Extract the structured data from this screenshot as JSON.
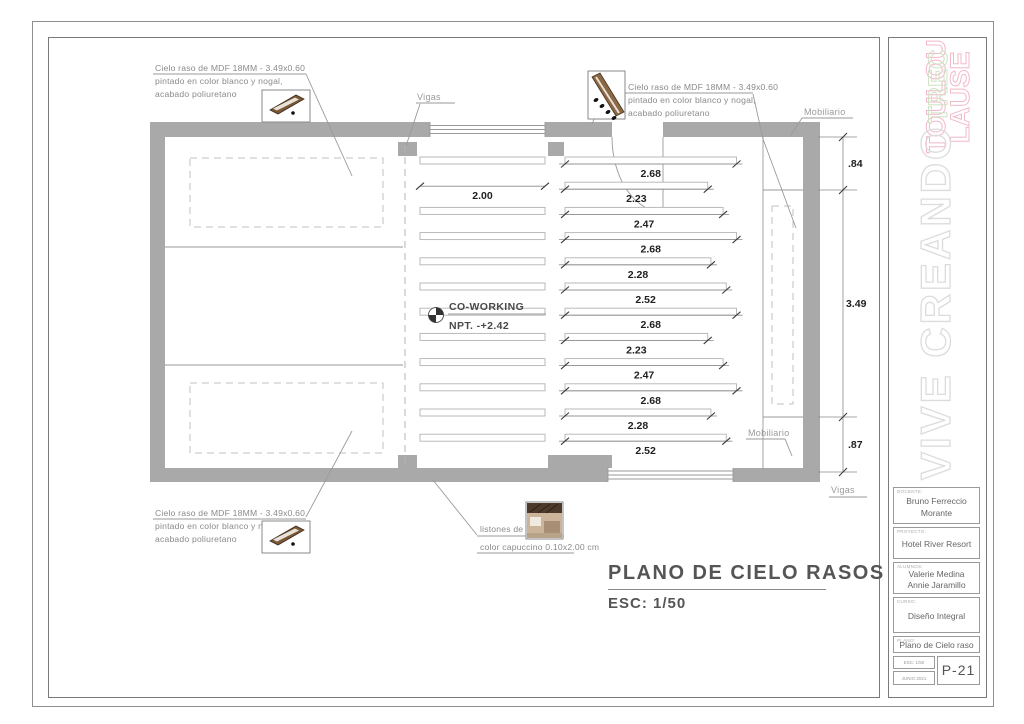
{
  "colors": {
    "wall": "#a9a9a9",
    "line": "#9a9a9a",
    "dim_text": "#1f1f1f",
    "note_text": "#8a8a8a",
    "accent_pink": "#f2b9c9",
    "accent_green": "#cfe3c5",
    "watermark": "#dcdcdc",
    "title_text": "#555555"
  },
  "drawing": {
    "title": "PLANO DE CIELO RASOS",
    "scale": "ESC: 1/50",
    "room": {
      "name": "CO-WORKING",
      "level": "NPT. -+2.42"
    },
    "notes": {
      "mdf_top_left": [
        "Cielo raso de MDF 18MM - 3.49x0.60",
        "pintado en color blanco y nogal,",
        "acabado poliuretano"
      ],
      "mdf_top_right": [
        "Cielo raso de MDF 18MM - 3.49x0.60",
        "pintado en color blanco y nogal,",
        "acabado poliuretano"
      ],
      "mdf_bottom_left": [
        "Cielo raso de MDF 18MM - 3.49x0.60",
        "pintado en color blanco y nogal,",
        "acabado poliuretano"
      ],
      "listones": [
        "listones de madera,",
        "color capuccino 0.10x2.00 cm"
      ]
    },
    "labels": {
      "vigas_top": "Vigas",
      "vigas_bottom": "Vigas",
      "mobiliario_top": "Mobiliario",
      "mobiliario_bottom": "Mobiliario"
    },
    "dims": {
      "left": "2.00",
      "right": [
        "2.68",
        "2.23",
        "2.47",
        "2.68",
        "2.28",
        "2.52",
        "2.68",
        "2.23",
        "2.47",
        "2.68",
        "2.28",
        "2.52"
      ],
      "side": [
        ".84",
        "3.49",
        ".87"
      ]
    }
  },
  "titleblock": {
    "logo_lines": [
      "TOULOU",
      "LAUSE",
      "TREC"
    ],
    "watermark": "VIVE CREANDO",
    "docente_label": "DOCENTE:",
    "docente": "Bruno Ferreccio Morante",
    "proyecto_label": "PROYECTO:",
    "proyecto": "Hotel River Resort",
    "alumnos_label": "ALUMNOS:",
    "alumno1": "Valerie Medina",
    "alumno2": "Annie Jaramillo",
    "curso_label": "CURSO:",
    "curso": "Diseño Integral",
    "plano_label": "PLANO:",
    "plano": "Plano de Cielo raso",
    "esc": "ESC: 1/50",
    "fecha": "JUNIO 2021",
    "sheet": "P-21"
  }
}
